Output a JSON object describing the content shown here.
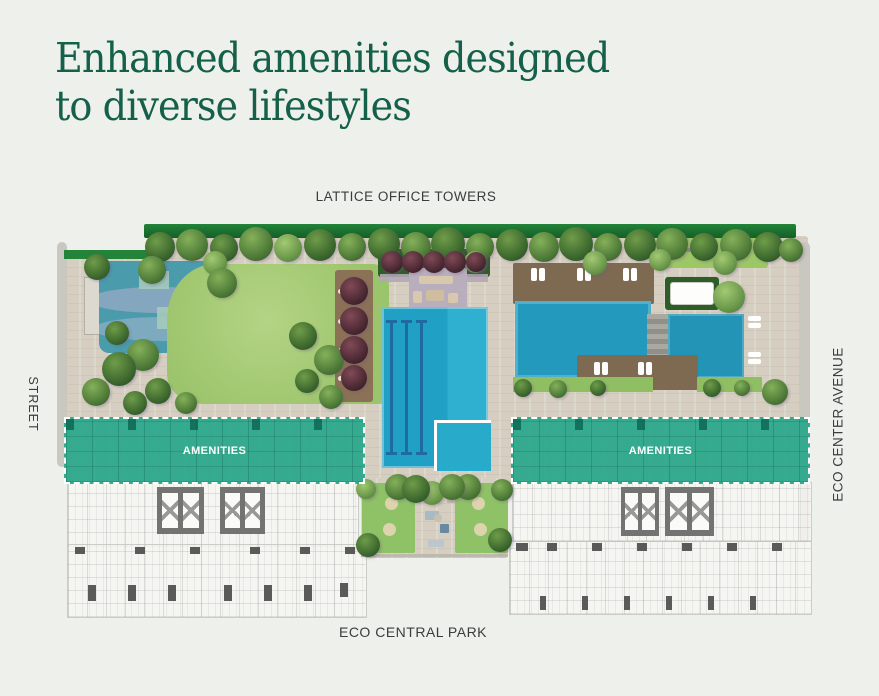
{
  "title": {
    "line1": "Enhanced amenities designed",
    "line2": "to diverse lifestyles"
  },
  "labels": {
    "top": "LATTICE OFFICE TOWERS",
    "left": "STREET",
    "right": "ECO CENTER AVENUE",
    "bottom": "ECO CENTRAL PARK"
  },
  "overlays": {
    "left_label": "AMENITIES",
    "right_label": "AMENITIES"
  },
  "colors": {
    "background": "#eef0ec",
    "title_green": "#15604a",
    "amenities_teal": "#2ca88b",
    "pool_blue": "#21a2c5",
    "lane_blue": "#1e6ba0",
    "lawn_green": "#a4ca72",
    "paving_beige": "#d6cfc1",
    "hedge_green": "#1f7c33",
    "deck_brown": "#7d6a51",
    "pond_blue": "#4a9cad",
    "label_gray": "#3c3c3c"
  }
}
